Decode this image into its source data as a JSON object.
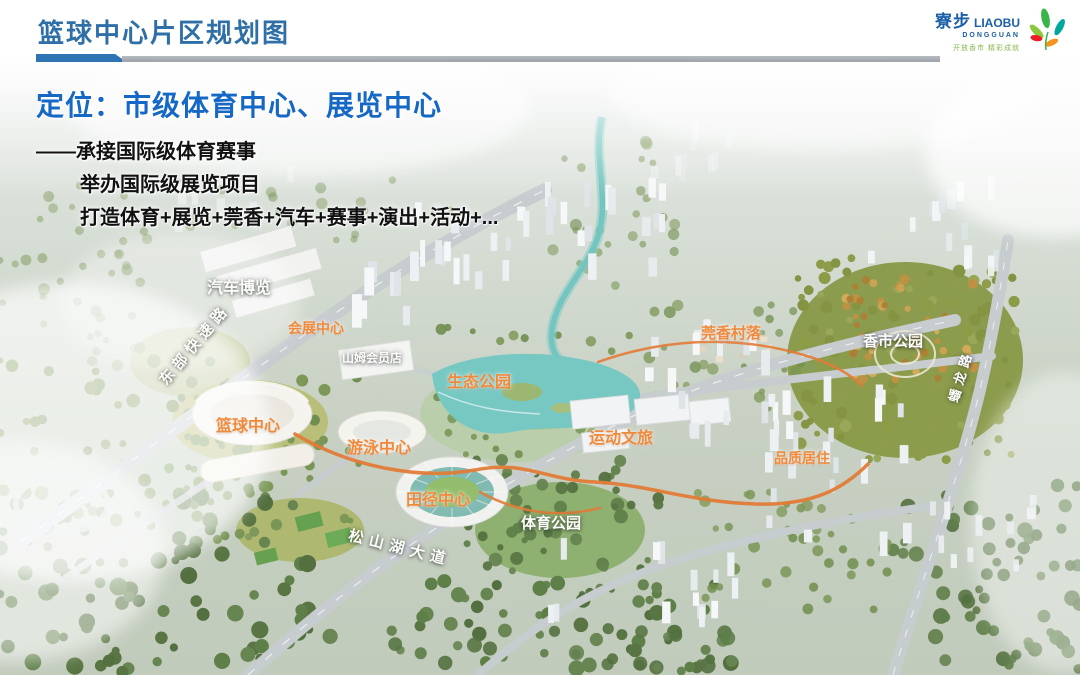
{
  "slide": {
    "title": "篮球中心片区规划图"
  },
  "logo": {
    "name_cn": "寮步",
    "name_en": "LIAOBU",
    "name_sub": "DONGGUAN",
    "slogan": "开放香市 精彩成就"
  },
  "overlay": {
    "title": "定位：市级体育中心、展览中心",
    "lines": [
      "——承接国际级体育赛事",
      "举办国际级展览项目",
      "打造体育+展览+莞香+汽车+赛事+演出+活动+..."
    ]
  },
  "map": {
    "labels": [
      {
        "id": "auto-expo",
        "text": "汽车博览"
      },
      {
        "id": "east-expressway",
        "text": "东部快速路"
      },
      {
        "id": "convention-center",
        "text": "会展中心"
      },
      {
        "id": "sams-club",
        "text": "山姆会员店"
      },
      {
        "id": "eco-park",
        "text": "生态公园"
      },
      {
        "id": "basketball-center",
        "text": "篮球中心"
      },
      {
        "id": "swimming-center",
        "text": "游泳中心"
      },
      {
        "id": "athletics-center",
        "text": "田径中心"
      },
      {
        "id": "sports-park",
        "text": "体育公园"
      },
      {
        "id": "sports-tourism",
        "text": "运动文旅"
      },
      {
        "id": "guanxiang-village",
        "text": "莞香村落"
      },
      {
        "id": "xiangshi-park",
        "text": "香市公园"
      },
      {
        "id": "quality-residence",
        "text": "品质居住"
      },
      {
        "id": "songshanhu-avenue",
        "text": "松山湖大道"
      },
      {
        "id": "panlong-road",
        "text": "蟠龙路"
      }
    ]
  },
  "colors": {
    "header_blue": "#2f6fa7",
    "accent_bar_blue": "#2e74b5",
    "bar_gray": "#a6abb0",
    "overlay_title_blue": "#1668c7",
    "label_orange": "#ef8a3c",
    "label_white": "#ffffff",
    "brand_blue": "#1a5fa8",
    "brand_green": "#86b94c"
  }
}
